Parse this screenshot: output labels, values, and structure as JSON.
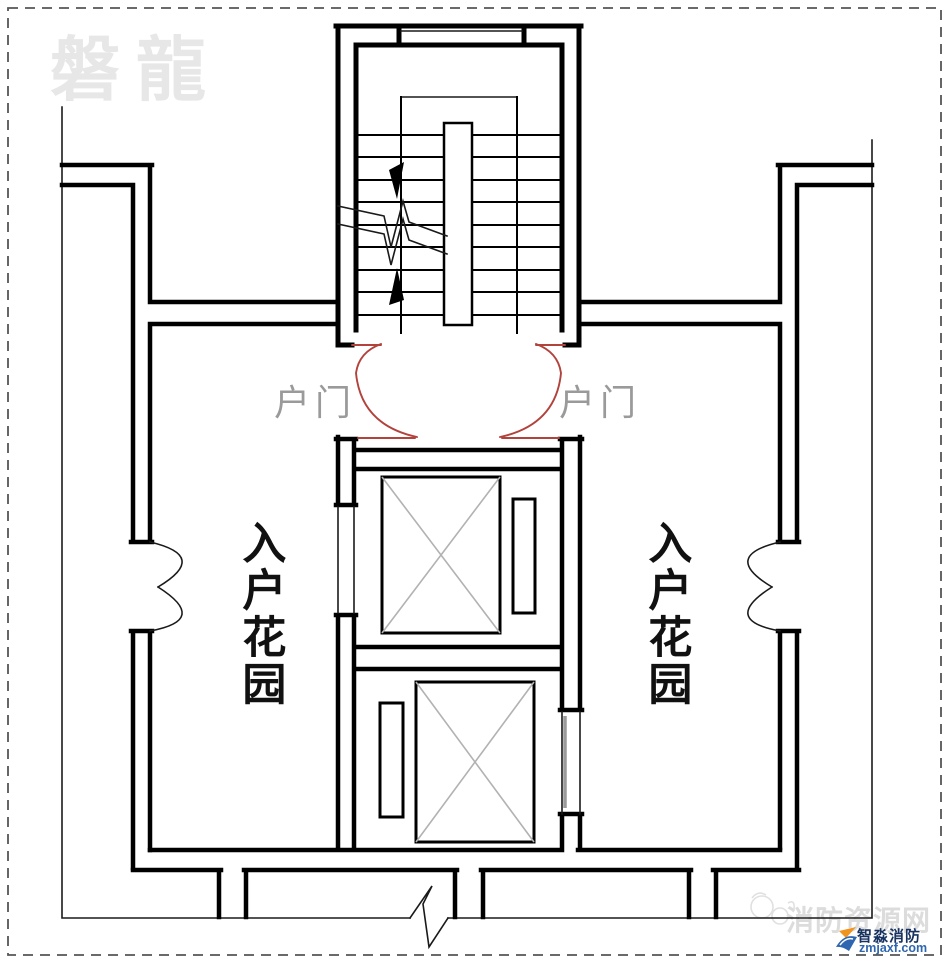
{
  "meta": {
    "description": "Residential building floor plan of stair and elevator core with entry gardens"
  },
  "watermarks": {
    "top_left_brand": "磐龍",
    "site_name": "消防资源网",
    "brand_name": "智淼消防",
    "brand_domain": "zmjaxf.com"
  },
  "labels": {
    "entry_door_left": "户门",
    "entry_door_right": "户门",
    "entry_garden_left": "入户花园",
    "entry_garden_right": "入户花园"
  },
  "colors": {
    "wall": "#000000",
    "thin_line": "#1a1a1a",
    "door_swing_red": "#b2423c",
    "door_label_gray": "#9a9a9a",
    "garden_label_black": "#111111",
    "elevator_cross_gray": "#b2b2b2",
    "elevator_door_gray": "#9a9a9a",
    "dash_border_gray": "#555555",
    "watermark_light_gray": "#e7e7e7",
    "site_watermark_gray": "#dcdcdc",
    "doodle_gray": "#e0e0e0",
    "brand_navy": "#17325f",
    "brand_blue": "#2e66b0",
    "logo_orange": "#f0941f"
  }
}
